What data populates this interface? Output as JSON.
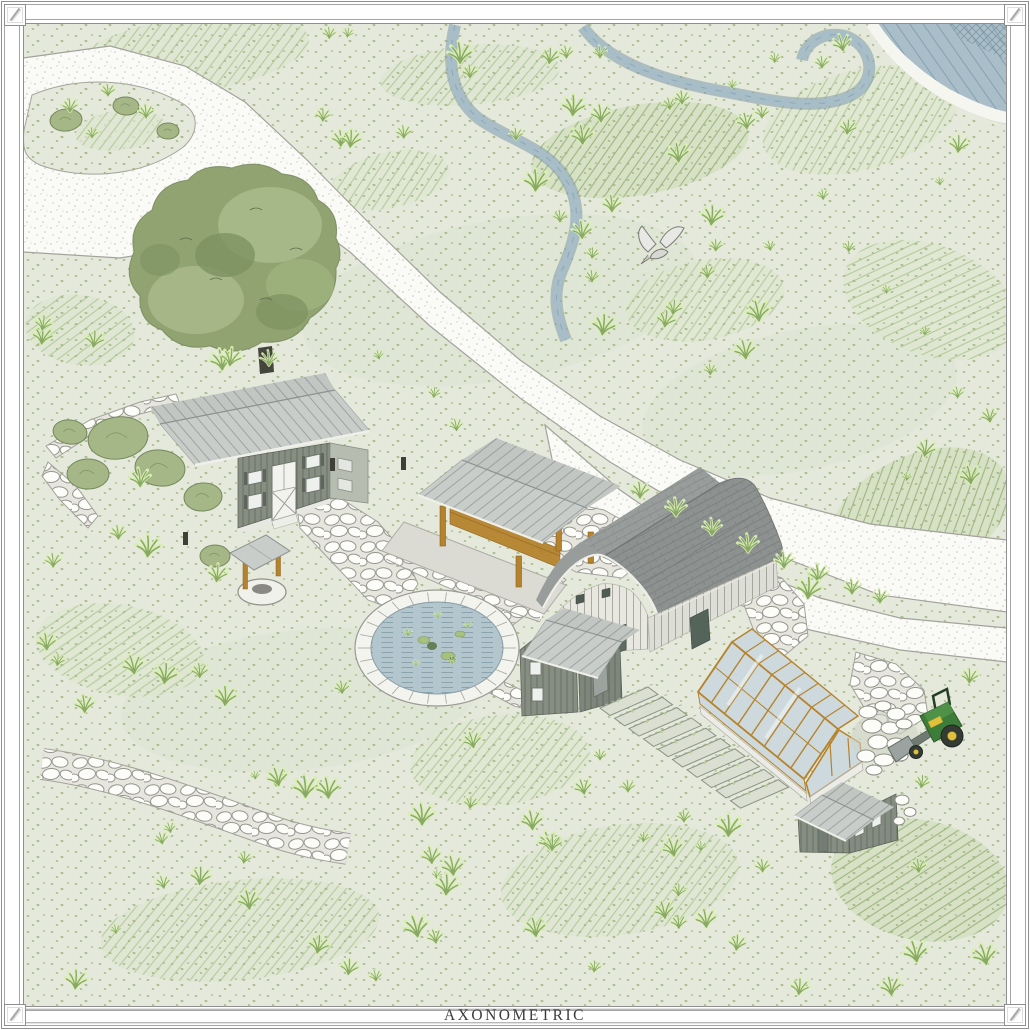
{
  "sheet": {
    "title": "AXONOMETRIC"
  },
  "palette": {
    "paper": "#ffffff",
    "title_ink": "#3c3c3c",
    "meadow": "#e5e9dc",
    "stipple": "#a6b987",
    "road": "#fafaf7",
    "stone": "#fcfcf9",
    "water_pond": "#b3c6ce",
    "water_pool": "#a9bec9",
    "creek": "#a7bdc8",
    "canopy": "#91a371",
    "canopy_light": "#a9ba8a",
    "shrub": "#a6b787",
    "roof_metal": "#c9cdca",
    "roof_barn": "#8d9291",
    "wall_olive": "#868d81",
    "wall_cream": "#e9e8e0",
    "timber": "#b5832d",
    "glass": "#cdd9dc",
    "tractor_green": "#3e7c39",
    "tractor_yellow": "#e0bf3a"
  },
  "scene": {
    "elements": [
      "meadow",
      "gravel-driveway",
      "driveway-island",
      "creek",
      "swimming-pond",
      "oak-tree",
      "farmhouse",
      "water-well",
      "timber-pavilion",
      "gambrel-barn",
      "equipment-shed",
      "greenhouse",
      "raised-garden-beds",
      "garden-shed",
      "garden-pond",
      "stone-paths",
      "rock-pile",
      "tractor",
      "flying-bird"
    ]
  }
}
